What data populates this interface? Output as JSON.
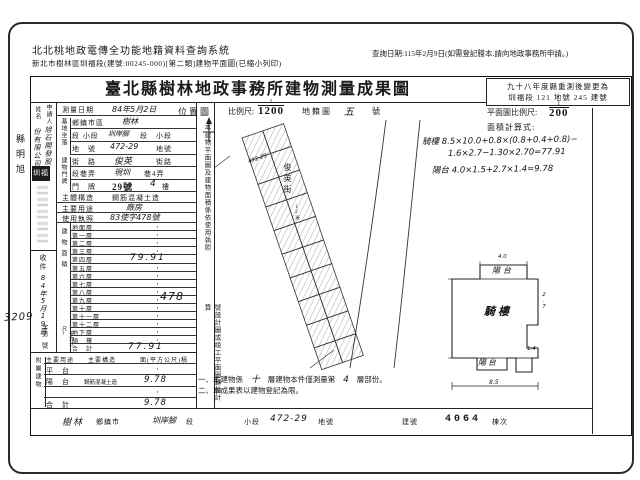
{
  "header": {
    "system_title": "北北桃地政電傳全功能地籍資料查詢系統",
    "subtitle": "新北市樹林區圳福段(建號:00245-000)[第二類]建物平面圖(已縮小列印)",
    "query_date": "查詢日期:115年2月9日(如需登記謄本,請向地政事務所申請。)"
  },
  "margin": {
    "left_stamp": "縣明旭",
    "receipt_overflow_no": "3209"
  },
  "form": {
    "title": "臺北縣樹林地政事務所建物測量成果圖",
    "remeasure_box": {
      "line1": "九十八年度縣重測後變更為",
      "line2": "圳福段 121 地號 245 建號"
    },
    "location_row": {
      "label": "位置圖",
      "scale_label": "比例尺:",
      "scale_num": "1",
      "scale_den": "1200",
      "cadastral_label": "地籍圖",
      "sheet_no": "五",
      "sheet_unit": "號"
    },
    "plan_box": {
      "scale_label": "平面圖比例尺:",
      "scale_num": "1",
      "scale_den": "200",
      "calc_label": "面積計算式:",
      "calc_lines": [
        "騎樓 8.5×10.0+0.8×(0.8+0.4+0.8)−",
        "1.6×2.7−1.30×2.70=77.91",
        "陽台 4.0×1.5+2.7×1.4=9.78"
      ]
    },
    "applicant": {
      "label_right": "申請人",
      "label_left": "姓名",
      "name_right": "旭石開發股",
      "name_left": "份有限公司"
    },
    "seal": "圳福",
    "survey_date": {
      "label": "測量日期",
      "value": "84年5月2日"
    },
    "site": {
      "group": "基地坐落",
      "rows": [
        {
          "label": "鄉鎮市區",
          "pre": "",
          "hand": "樹林",
          "suf": ""
        },
        {
          "label": "段 小段",
          "pre": "",
          "hand": "圳岸腳",
          "suf": "段　小段"
        },
        {
          "label": "地　號",
          "pre": "",
          "hand": "472-29",
          "suf": "地號"
        }
      ]
    },
    "address": {
      "group": "建物門牌",
      "rows": [
        {
          "label": "街　路",
          "pre": "",
          "hand": "俊英",
          "suf": "街路"
        },
        {
          "label": "段巷弄",
          "pre": "",
          "hand": "現圳",
          "suf": "巷4弄"
        },
        {
          "label": "門　牌",
          "pre": "29號",
          "hand": "4",
          "suf": "樓"
        }
      ]
    },
    "structure": {
      "label": "主體構造",
      "value": "鋼筋混凝土造"
    },
    "usage": {
      "label": "主要用途",
      "value": "廠房"
    },
    "license": {
      "label": "使用執照",
      "value": "83使字478號"
    },
    "floor_area": {
      "group": "建物面積",
      "unit": "(平方公尺)",
      "rows": [
        [
          "地面層",
          "·"
        ],
        [
          "第一層",
          "·"
        ],
        [
          "第二層",
          "·"
        ],
        [
          "第三層",
          "·"
        ],
        [
          "第四層",
          "79.91"
        ],
        [
          "第五層",
          "·"
        ],
        [
          "第六層",
          "·"
        ],
        [
          "第七層",
          "·"
        ],
        [
          "第八層",
          "·"
        ],
        [
          "第九層",
          "·"
        ],
        [
          "第十層",
          "·"
        ],
        [
          "第十一層",
          "·"
        ],
        [
          "第十二層",
          "·"
        ],
        [
          "地下層",
          "·"
        ],
        [
          "騎　樓",
          "·"
        ],
        [
          "合　計",
          "77.91"
        ]
      ]
    },
    "receipt": {
      "label": "收件",
      "date": "84年5月19日",
      "zi": "字第",
      "hao": "號"
    },
    "annotation": {
      "seg1": "本建物平面圖及建物面積係依使用執照",
      "hand_no": "478",
      "seg2": "號設計圖或竣工平面圖轉繪計算"
    },
    "annex": {
      "group": "附屬建物",
      "headers": [
        "主要用途",
        "主要構造",
        "面(平方公尺)積"
      ],
      "rows": [
        [
          "平　台",
          "",
          "·"
        ],
        [
          "陽　台",
          "鋼筋混凝土造",
          "9.78"
        ],
        [
          "",
          "",
          "·"
        ],
        [
          "合　計",
          "",
          "9.78"
        ]
      ]
    },
    "map": {
      "road": "俊英街",
      "road_note": "12米",
      "parcel": "472-29"
    },
    "floor_plan": {
      "balcony_top": "陽台",
      "main": "騎樓",
      "balcony_bottom": "陽台",
      "dim_top": "4.0",
      "dim_right": "2.7",
      "dim_foot": "1.4",
      "dim_bottom": "8.5"
    },
    "notes": {
      "n1_pre": "一、本建物係",
      "n1_hand1": "十",
      "n1_mid": "層建物本件僅測量第",
      "n1_hand2": "4",
      "n1_suf": "層部份。",
      "n2": "二、本成果表以建物登記為限。"
    },
    "bottom_strip": {
      "township_hand": "樹林",
      "township_label": "鄉鎮市",
      "section_hand": "圳岸腳",
      "section_label": "段",
      "subsection_label": "小段",
      "parcel_hand": "472-29",
      "parcel_label": "地號",
      "building_label": "建號",
      "building_no": "4064",
      "unit_label": "棟次"
    }
  }
}
